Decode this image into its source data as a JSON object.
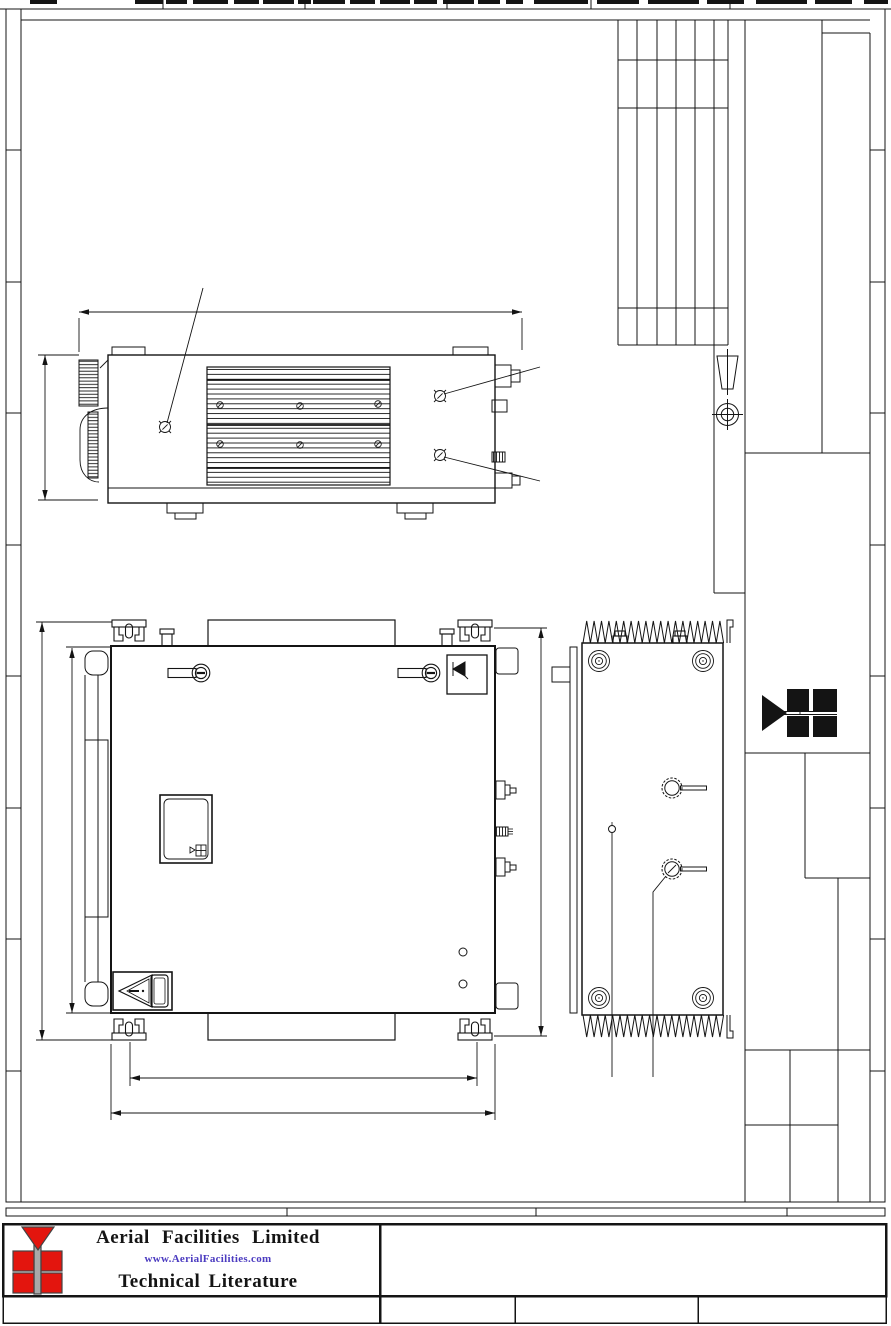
{
  "document": {
    "kind": "scanned engineering drawing sheet"
  },
  "footer": {
    "company_name": "Aerial Facilities Limited",
    "website": "www.AerialFacilities.com",
    "document_type": "Technical Literature"
  },
  "colors": {
    "line": "#141414",
    "logo_red": "#e3150e",
    "logo_gray": "#a9a9a9",
    "website_blue": "#4b3bc0",
    "background": "#ffffff"
  },
  "icons": {
    "first_angle_projection_icon": "truncated cone above circled crosshair",
    "afl_arrow_icon": "right-pointing black triangle with 2x2 black squares",
    "afl_red_logo_icon": "down-pointing red triangle above 2x2 red squares on gray mast",
    "warning_triangle_icon": "left-pointing exclamation triangle label",
    "buzzer_icon": "small speaker / alarm glyph in square box",
    "captive_screw_icon": "slotted captive screw with bar",
    "torx_screw_icon": "circled screw head with tick marks"
  }
}
